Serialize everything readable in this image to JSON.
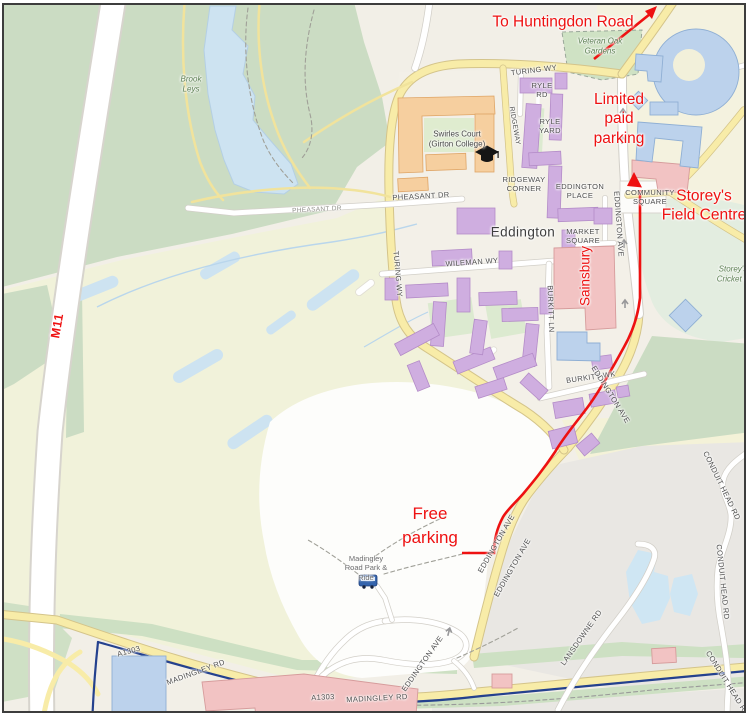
{
  "map": {
    "kind": "street-map-with-directions",
    "area_label": "Eddington"
  },
  "colors": {
    "annotation_red": "#ee1111",
    "route_red": "#ee1111",
    "boundary_navy": "#24418e",
    "water_blue": "#cde3f1",
    "road_yellow": "#f8eca8",
    "park_green": "#cbdcc3",
    "grass_green": "#cde0c3",
    "farmland": "#f1f2da",
    "urban_gray": "#e9e7e3",
    "building_purple": "#cfaee0",
    "building_orange": "#f6cf9f",
    "building_pink": "#f2c3c3",
    "building_blue": "#bcd2ec"
  },
  "annotations": {
    "to_huntingdon_road": "To Huntingdon Road",
    "limited_paid_parking": [
      "Limited",
      "paid",
      "parking"
    ],
    "storeys_field_centre": [
      "Storey's",
      "Field Centre"
    ],
    "sainsbury": "Sainsbury",
    "free_parking": [
      "Free",
      "parking"
    ],
    "m11": "M11"
  },
  "route": {
    "color": "#ee1111",
    "endpoints": [
      "Community Square / Storey's Field Centre",
      "Free parking"
    ]
  },
  "map_labels": [
    {
      "text": "TURING WY"
    },
    {
      "text": "TURING WY"
    },
    {
      "l1": "RYLE",
      "l2": "RD"
    },
    {
      "l1": "RYLE",
      "l2": "YARD"
    },
    {
      "text": "RIDGEWAY"
    },
    {
      "l1": "RIDGEWAY",
      "l2": "CORNER"
    },
    {
      "l1": "EDDINGTON",
      "l2": "PLACE"
    },
    {
      "text": "PHEASANT DR"
    },
    {
      "text": "PHEASANT DR"
    },
    {
      "l1": "MARKET",
      "l2": "SQUARE"
    },
    {
      "l1": "COMMUNITY",
      "l2": "SQUARE"
    },
    {
      "text": "WILEMAN WY"
    },
    {
      "text": "BURKITT LN"
    },
    {
      "text": "BURKITT WK"
    },
    {
      "text": "EDDINGTON AVE"
    },
    {
      "text": "EDDINGTON AVE"
    },
    {
      "text": "EDDINGTON AVE"
    },
    {
      "text": "EDDINGTON AVE"
    },
    {
      "text": "EDDINGTON AVE"
    },
    {
      "text": "A1303"
    },
    {
      "text": "MADINGLEY RD"
    },
    {
      "text": "A1303"
    },
    {
      "text": "MADINGLEY RD"
    },
    {
      "text": "LANSDOWNE RD"
    },
    {
      "text": "CONDUIT HEAD RD"
    },
    {
      "text": "CONDUIT HEAD RD"
    },
    {
      "text": "CONDUIT HEAD RD"
    },
    {
      "text": "Eddington"
    },
    {
      "l1": "Swirles Court",
      "l2": "(Girton College)"
    },
    {
      "l1": "Brook",
      "l2": "Leys"
    },
    {
      "l1": "Veteran Oak",
      "l2": "Gardens"
    },
    {
      "l1": "Storey's",
      "l2": "Cricket P"
    },
    {
      "l1": "Madingley",
      "l2": "Road Park &",
      "l3": "Ride"
    }
  ],
  "icons": {
    "bus": "bus-icon",
    "graduation_cap": "graduation-cap-icon",
    "one_way_arrow": "one-way-arrow-icon",
    "route_arrowhead": "route-arrowhead-icon",
    "direction_arrow": "huntingdon-direction-arrow-icon"
  }
}
